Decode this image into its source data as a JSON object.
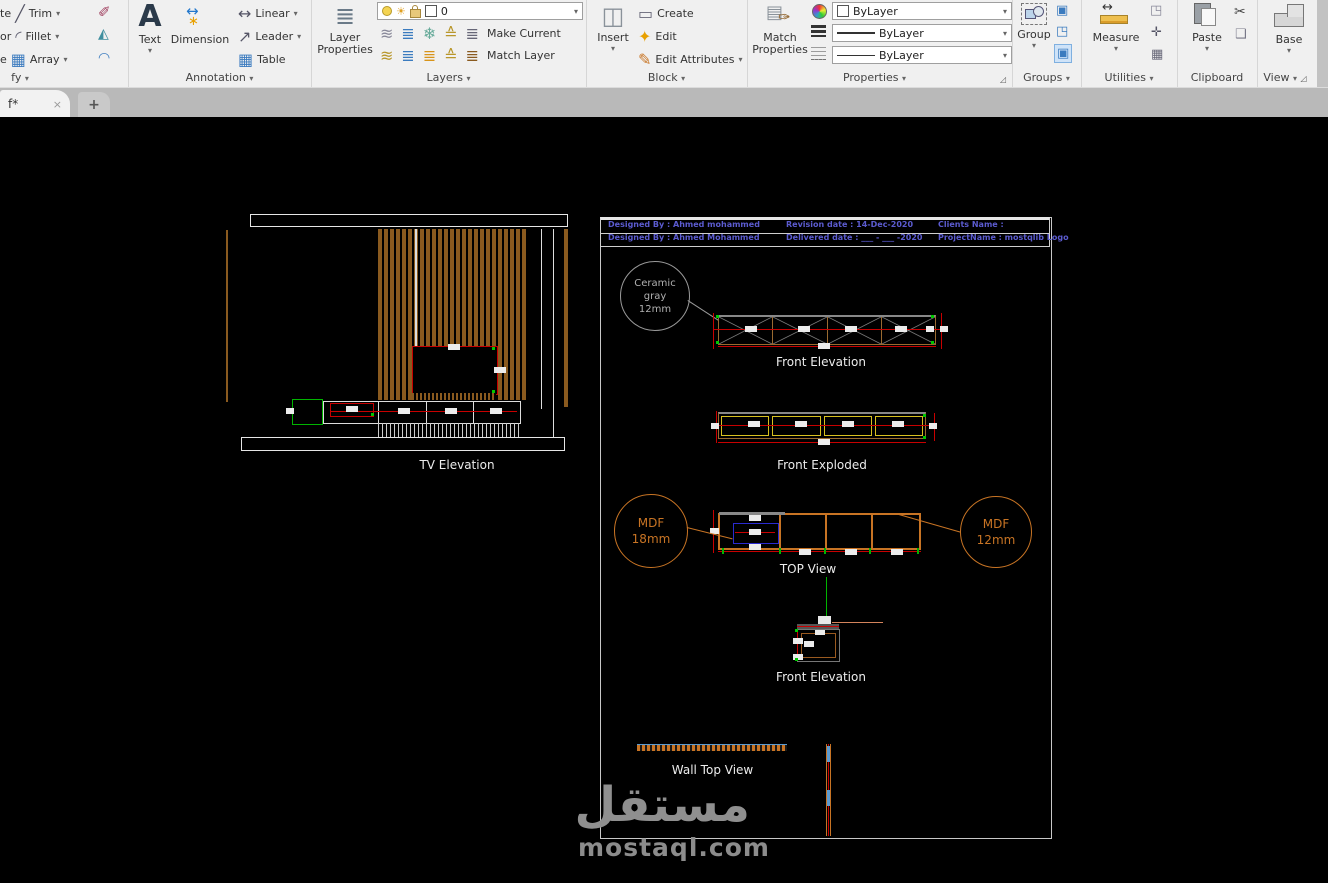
{
  "ribbon": {
    "modify": {
      "panel_label": "fy",
      "fragments": [
        "te",
        "or",
        "e"
      ],
      "items": [
        "Trim",
        "Fillet",
        "Array"
      ]
    },
    "annotation": {
      "panel_label": "Annotation",
      "text": "Text",
      "dimension": "Dimension",
      "linear": "Linear",
      "leader": "Leader",
      "table": "Table"
    },
    "layers": {
      "panel_label": "Layers",
      "layer_properties_1": "Layer",
      "layer_properties_2": "Properties",
      "current_layer": "0",
      "make_current": "Make Current",
      "match_layer": "Match Layer"
    },
    "block": {
      "panel_label": "Block",
      "insert": "Insert",
      "create": "Create",
      "edit": "Edit",
      "edit_attributes": "Edit Attributes"
    },
    "properties": {
      "panel_label": "Properties",
      "match_1": "Match",
      "match_2": "Properties",
      "color": "ByLayer",
      "lineweight": "ByLayer",
      "linetype": "ByLayer"
    },
    "groups": {
      "panel_label": "Groups",
      "group": "Group"
    },
    "utilities": {
      "panel_label": "Utilities",
      "measure": "Measure"
    },
    "clipboard": {
      "panel_label": "Clipboard",
      "paste": "Paste"
    },
    "view": {
      "panel_label": "View",
      "base": "Base"
    }
  },
  "tabs": {
    "active": "f*",
    "close": "×",
    "new": "+"
  },
  "canvas": {
    "tv_elevation": {
      "label": "TV Elevation"
    },
    "sheet": {
      "title_block": {
        "designed_by_1": "Designed By : Ahmed mohammed",
        "designed_by_2": "Designed By : Ahmed Mohammed",
        "revision_date": "Revision date : 14-Dec-2020",
        "delivered_date": "Delivered date :  ___ - ___ -2020",
        "clients_name": "Clients Name :",
        "project_name": "ProjectName : mostqlib Logo"
      },
      "ceramic_callout": {
        "line1": "Ceramic",
        "line2": "gray",
        "line3": "12mm"
      },
      "mdf18_callout": {
        "line1": "MDF",
        "line2": "18mm"
      },
      "mdf12_callout": {
        "line1": "MDF",
        "line2": "12mm"
      },
      "front_elevation_label": "Front Elevation",
      "front_exploded_label": "Front Exploded",
      "top_view_label": "TOP View",
      "front_elevation_2_label": "Front Elevation",
      "wall_top_view_label": "Wall Top View"
    }
  },
  "watermark": {
    "arabic": "مستقل",
    "latin": "mostaql.com"
  },
  "colors": {
    "wood": "#8a5a1f",
    "dim_red": "#c80000",
    "accent_green": "#00c800",
    "callout_orange": "#c87424",
    "title_text_blue": "#5b5bcf",
    "brace_gray": "#909090",
    "exploded_yellow": "#d8c020",
    "blue_part": "#2a2ad0"
  }
}
